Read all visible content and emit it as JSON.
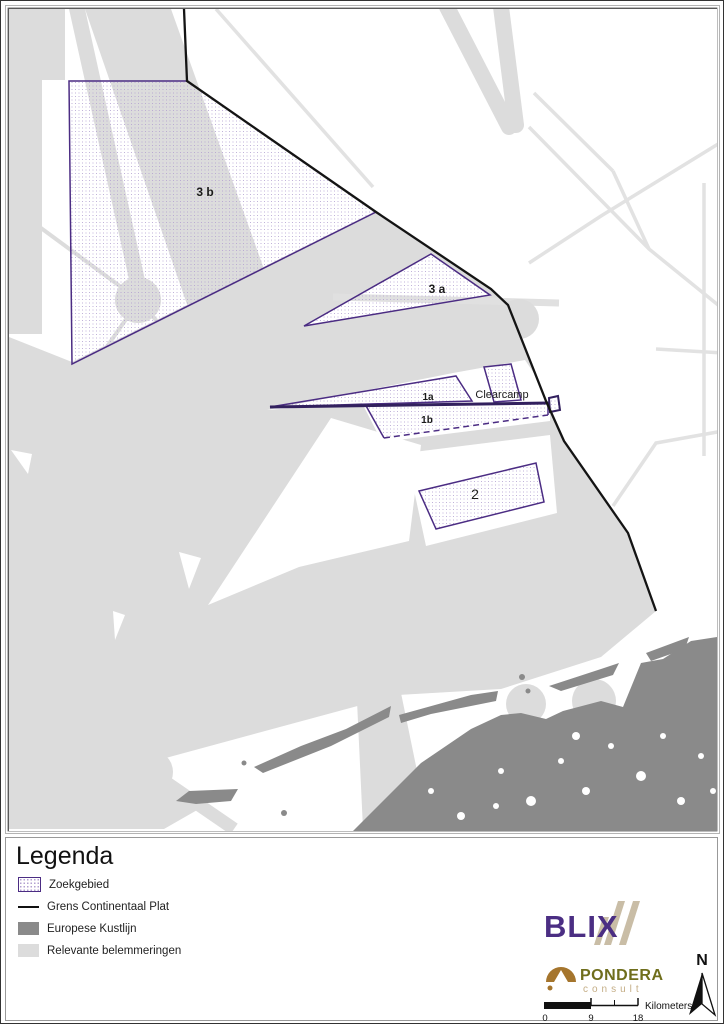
{
  "map": {
    "area_labels": [
      {
        "name": "zone-3b",
        "text": "3 b"
      },
      {
        "name": "zone-3a",
        "text": "3 a"
      },
      {
        "name": "zone-1a",
        "text": "1a"
      },
      {
        "name": "zone-1b",
        "text": "1b"
      },
      {
        "name": "clearcamp",
        "text": "Clearcamp"
      },
      {
        "name": "zone-2",
        "text": "2"
      }
    ]
  },
  "legend": {
    "title": "Legenda",
    "items": [
      {
        "label": "Zoekgebied",
        "type": "zoekgebied"
      },
      {
        "label": "Grens Continentaal Plat",
        "type": "line"
      },
      {
        "label": "Europese Kustlijn",
        "type": "dark"
      },
      {
        "label": "Relevante belemmeringen",
        "type": "light"
      }
    ]
  },
  "logos": {
    "blix_text": "BLIX",
    "pondera_text": "PONDERA",
    "pondera_sub": "consult"
  },
  "scalebar": {
    "ticks": [
      "0",
      "9",
      "18"
    ],
    "unit": "Kilometers"
  },
  "north": {
    "label": "N"
  },
  "colors": {
    "search_area_border": "#4b2c83",
    "search_area_dots": "#b19fd0",
    "continental_line": "#141414",
    "coastline": "#8a8a8a",
    "obstructions": "#dcdcdc",
    "blix_purple": "#4b2e83",
    "blix_stripes": "#c9bda6",
    "pondera_brown": "#a5752d",
    "pondera_olive": "#6f6e1c",
    "pondera_tan": "#c4ad85"
  }
}
